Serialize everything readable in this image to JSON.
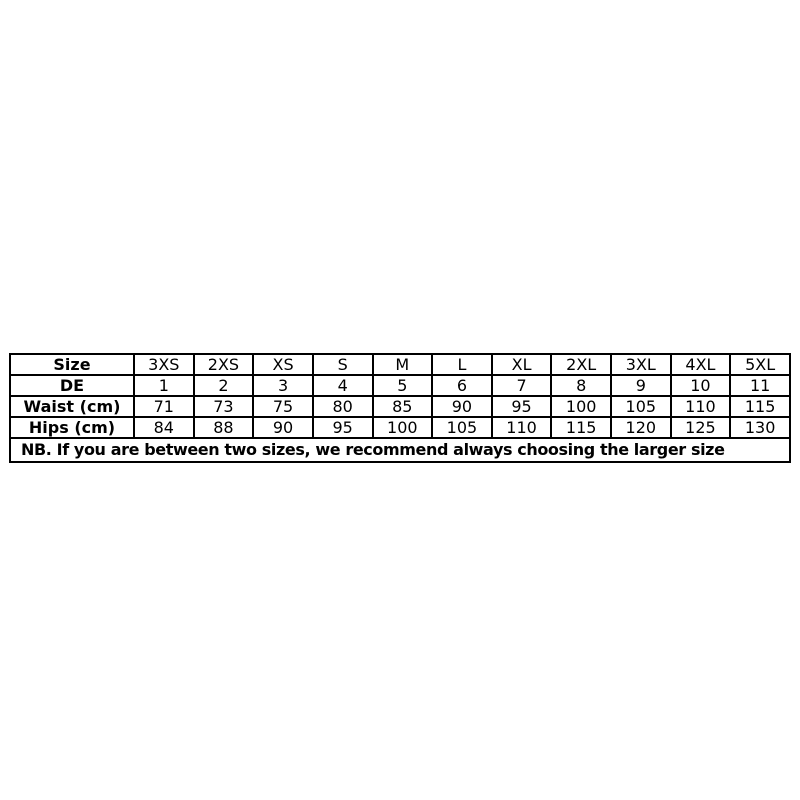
{
  "chart_data": {
    "type": "table",
    "title": "Size chart",
    "columns": [
      "Size",
      "3XS",
      "2XS",
      "XS",
      "S",
      "M",
      "L",
      "XL",
      "2XL",
      "3XL",
      "4XL",
      "5XL"
    ],
    "rows": [
      {
        "label": "DE",
        "values": [
          "1",
          "2",
          "3",
          "4",
          "5",
          "6",
          "7",
          "8",
          "9",
          "10",
          "11"
        ]
      },
      {
        "label": "Waist (cm)",
        "values": [
          "71",
          "73",
          "75",
          "80",
          "85",
          "90",
          "95",
          "100",
          "105",
          "110",
          "115"
        ]
      },
      {
        "label": "Hips (cm)",
        "values": [
          "84",
          "88",
          "90",
          "95",
          "100",
          "105",
          "110",
          "115",
          "120",
          "125",
          "130"
        ]
      }
    ],
    "note": "NB. If you are between two sizes, we recommend always choosing the larger size",
    "layout": {
      "border_color": "#000000",
      "text_color": "#000000",
      "background": "#ffffff",
      "grid": "on"
    }
  }
}
